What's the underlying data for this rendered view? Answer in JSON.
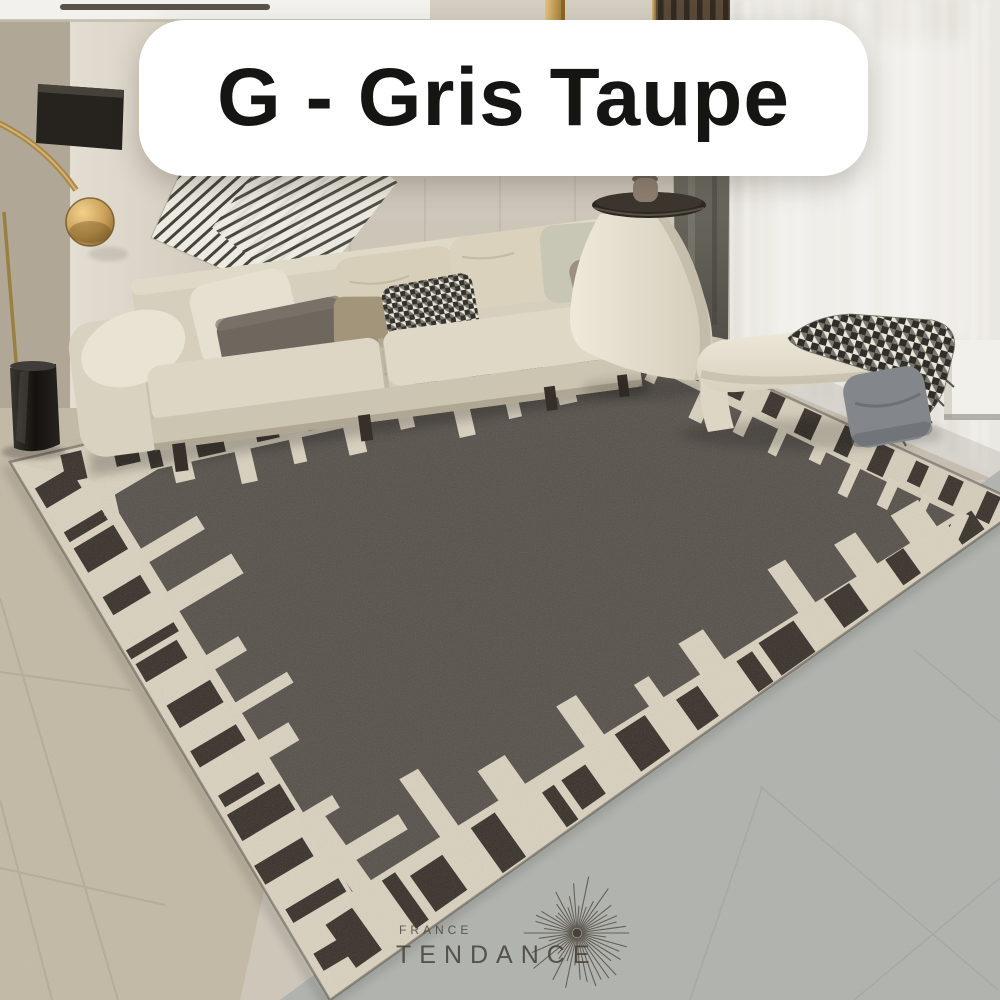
{
  "overlay": {
    "variant_label": "G - Gris Taupe",
    "label_bg": "#ffffff",
    "label_text_color": "#151514"
  },
  "watermark": {
    "line1": "FRANCE",
    "line2": "TENDANCE",
    "color": "#46413a",
    "icon": "starburst-icon"
  },
  "scene": {
    "subject": "gris taupe bordered rug in modern living room",
    "elements": [
      "rug",
      "sofa",
      "arc-floor-lamp",
      "black-vase",
      "side-console",
      "round-table-top",
      "bench",
      "houndstooth-throw",
      "gray-cushion",
      "sheer-curtain",
      "wood-slat-wall",
      "striped-textile",
      "wall-art-panel",
      "tiled-floor"
    ],
    "palette": {
      "rug_field": "#56504a",
      "rug_border": "#d5cdba",
      "rug_bars": "#38312a",
      "sofa_cream": "#d6cfbd",
      "wall_beige": "#cdc6b9",
      "wood_slats": "#594a39",
      "brass_gold": "#c9a25c",
      "curtain_white": "#eae8e2",
      "floor_left_beige": "#c3b9a6",
      "floor_right_gray": "#b0b3ae",
      "bench_cream": "#ebe5d6"
    }
  }
}
